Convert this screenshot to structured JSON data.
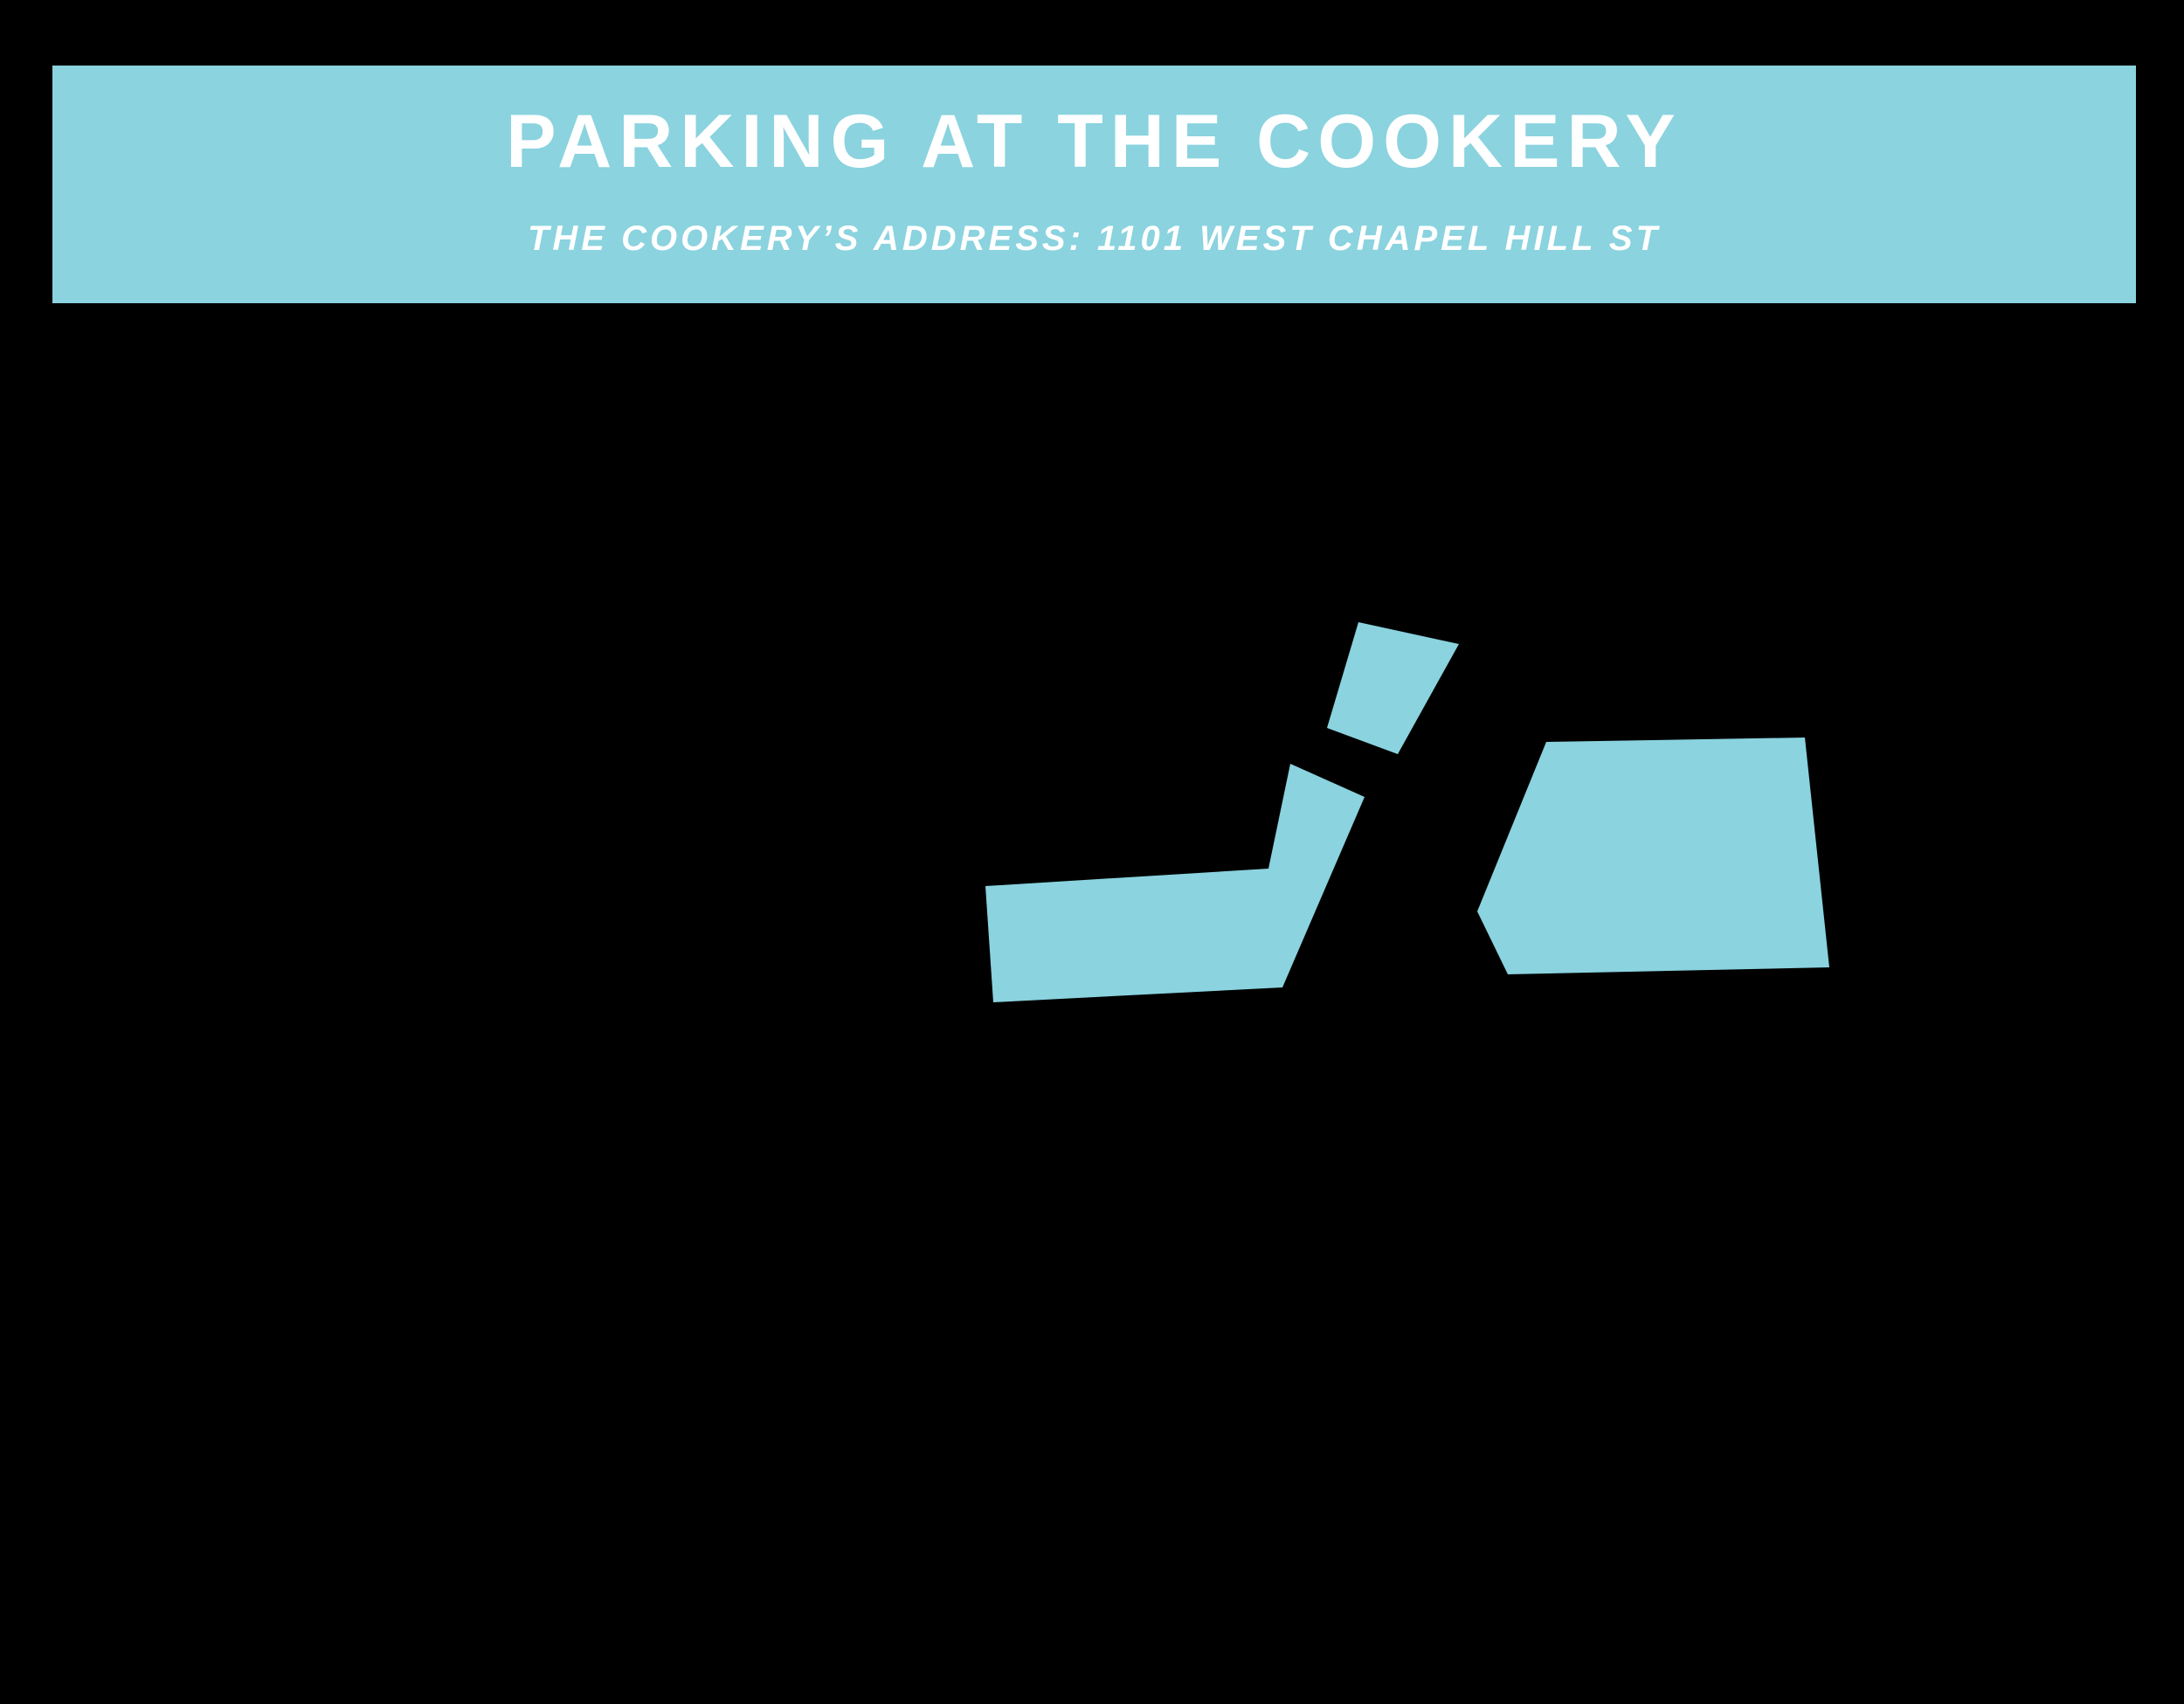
{
  "banner": {
    "title": "PARKING AT THE COOKERY",
    "subtitle": "THE COOKERY’S ADDRESS: 1101 WEST CHAPEL HILL ST",
    "background_color": "#8ad3df",
    "text_color": "#ffffff"
  },
  "map": {
    "background_color": "#000000",
    "highlight_color": "#8ad3df",
    "shapes": [
      {
        "name": "parking-area-upper-driveway",
        "points": [
          [
            1555,
            712
          ],
          [
            1670,
            737
          ],
          [
            1600,
            863
          ],
          [
            1519,
            833
          ]
        ]
      },
      {
        "name": "parking-area-l-shaped-lot",
        "points": [
          [
            1128,
            1014
          ],
          [
            1452,
            994
          ],
          [
            1477,
            874
          ],
          [
            1562,
            912
          ],
          [
            1468,
            1130
          ],
          [
            1137,
            1147
          ]
        ]
      },
      {
        "name": "parking-area-main-lot",
        "points": [
          [
            1770,
            849
          ],
          [
            2066,
            844
          ],
          [
            2094,
            1107
          ],
          [
            1726,
            1115
          ],
          [
            1691,
            1043
          ]
        ]
      }
    ]
  }
}
